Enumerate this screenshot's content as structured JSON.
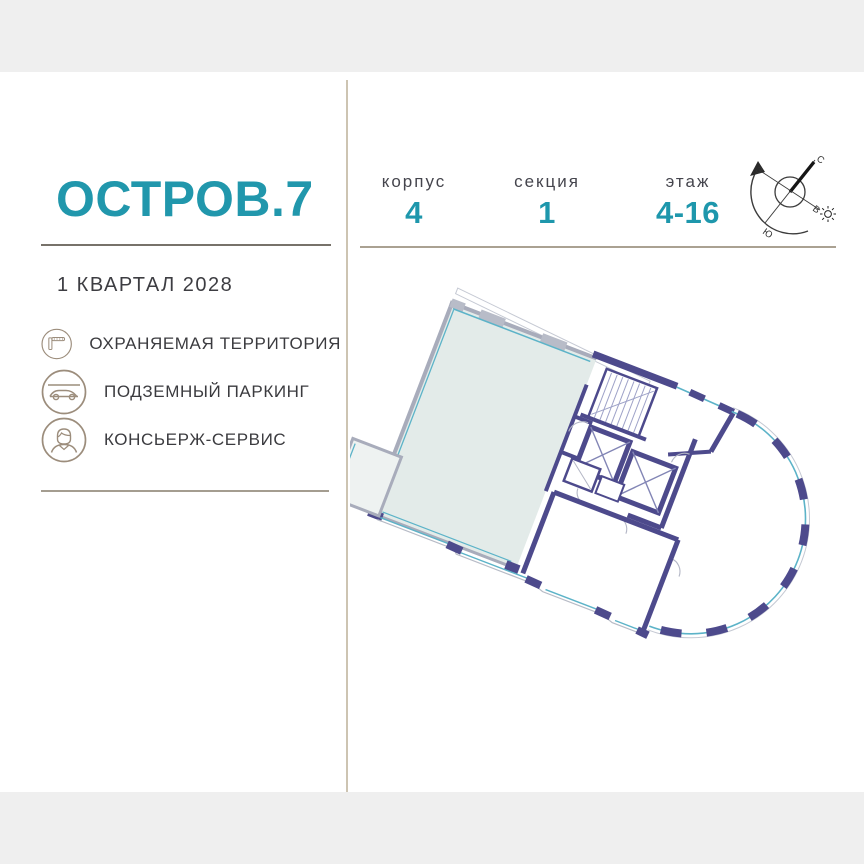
{
  "project": {
    "logo_text": "ОСТРОВ.7",
    "delivery": "1 КВАРТАЛ 2028"
  },
  "amenities": {
    "items": [
      {
        "icon": "barrier-icon",
        "label": "ОХРАНЯЕМАЯ ТЕРРИТОРИЯ"
      },
      {
        "icon": "car-icon",
        "label": "ПОДЗЕМНЫЙ ПАРКИНГ"
      },
      {
        "icon": "concierge-icon",
        "label": "КОНСЬЕРЖ-СЕРВИС"
      }
    ]
  },
  "unit_info": {
    "fields": [
      {
        "label": "корпус",
        "value": "4"
      },
      {
        "label": "секция",
        "value": "1"
      },
      {
        "label": "этаж",
        "value": "4-16"
      }
    ]
  },
  "compass": {
    "north": "С",
    "south": "Ю",
    "west": "З",
    "east": "В"
  },
  "plan": {
    "highlighted_unit": "apartment highlighted in light teal, building 4 / section 1"
  },
  "colors": {
    "accent_teal": "#2197ac",
    "value_teal": "#1e97ad",
    "wall_navy": "#4d4a8c",
    "glazing_teal": "#5cb3c8",
    "unit_fill": "#e3ebe9",
    "icon_outline": "#9c8d7c",
    "page_band": "#efefef"
  }
}
